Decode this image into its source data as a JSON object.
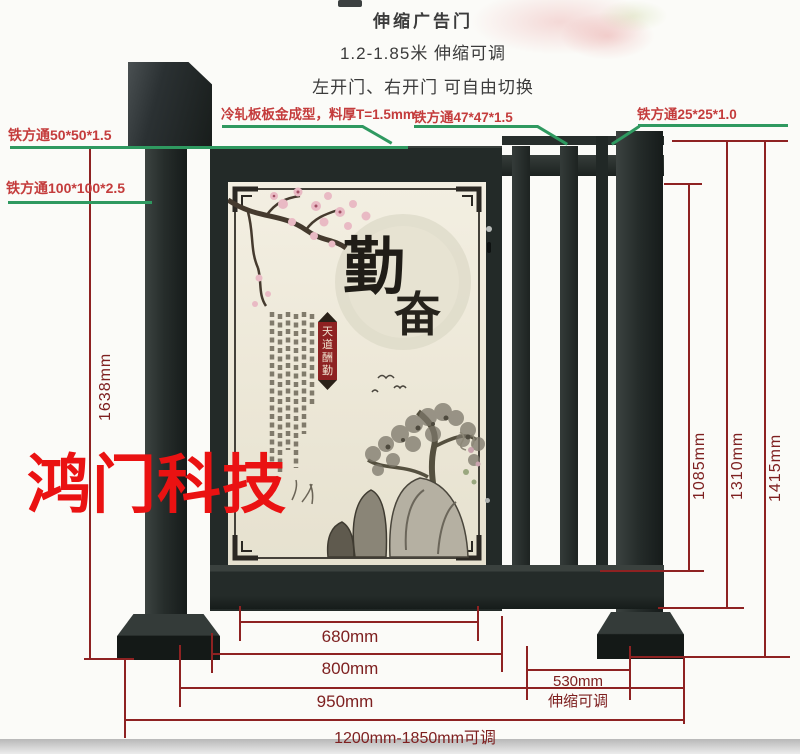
{
  "header": {
    "title": "伸缩广告门",
    "line2": "1.2-1.85米 伸缩可调",
    "line3": "左开门、右开门 可自由切换"
  },
  "watermark": {
    "text": "鸿门科技"
  },
  "callouts": {
    "tube50": "铁方通50*50*1.5",
    "tube100": "铁方通100*100*2.5",
    "sheet_metal": "冷轧板板金成型，料厚T=1.5mm",
    "tube47": "铁方通47*47*1.5",
    "tube25": "铁方通25*25*1.0"
  },
  "dimensions": {
    "h1638": "1638mm",
    "h1085": "1085mm",
    "h1310": "1310mm",
    "h1415": "1415mm",
    "w680": "680mm",
    "w800": "800mm",
    "w950": "950mm",
    "tele_value": "530mm",
    "tele_note": "伸缩可调",
    "range": "1200mm-1850mm可调"
  },
  "artwork": {
    "calligraphy_char1": "勤",
    "calligraphy_char2": "奋",
    "seal_chars": [
      "天",
      "道",
      "酬",
      "勤"
    ]
  },
  "colors": {
    "dim_line": "#8e2222",
    "callout_text": "#c43c3c",
    "leader_line": "#2f9960",
    "watermark_red": "#ea1212",
    "gate_dark": "#232a28",
    "panel_cream": "#ece7d7"
  }
}
